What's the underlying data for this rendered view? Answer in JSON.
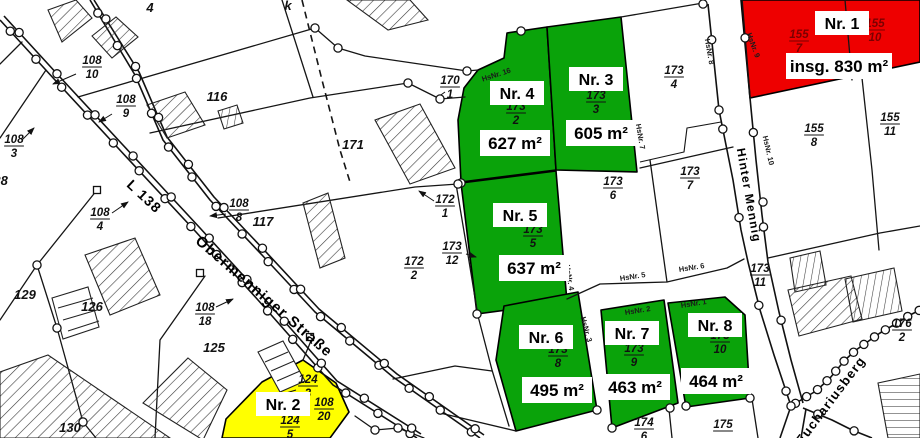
{
  "map": {
    "colors": {
      "lot_available": "#0AA30A",
      "lot_reserved": "#EE0000",
      "lot_sold": "#FFFF00",
      "parcel_label_red": "#7A0000",
      "background": "#FFFFFF"
    },
    "streets": [
      {
        "name": "L 138"
      },
      {
        "name": "Obermenniger Straße"
      },
      {
        "name": "Hinter Mennig"
      },
      {
        "name": "Euchariusberg"
      }
    ],
    "lots": [
      {
        "id": 1,
        "name": "Nr. 1",
        "area": "insg. 830 m²",
        "parcels": [
          "155/7",
          "155/10"
        ],
        "status_color": "lot_reserved"
      },
      {
        "id": 2,
        "name": "Nr. 2",
        "area": "",
        "parcels": [
          "124/3",
          "124/5",
          "108/20"
        ],
        "status_color": "lot_sold"
      },
      {
        "id": 3,
        "name": "Nr. 3",
        "area": "605 m²",
        "parcels": [
          "173/3"
        ],
        "status_color": "lot_available"
      },
      {
        "id": 4,
        "name": "Nr. 4",
        "area": "627 m²",
        "parcels": [
          "173/2"
        ],
        "status_color": "lot_available"
      },
      {
        "id": 5,
        "name": "Nr. 5",
        "area": "637 m²",
        "parcels": [
          "173/5"
        ],
        "status_color": "lot_available"
      },
      {
        "id": 6,
        "name": "Nr. 6",
        "area": "495 m²",
        "parcels": [
          "173/8"
        ],
        "status_color": "lot_available"
      },
      {
        "id": 7,
        "name": "Nr. 7",
        "area": "463 m²",
        "parcels": [
          "173/9"
        ],
        "status_color": "lot_available"
      },
      {
        "id": 8,
        "name": "Nr. 8",
        "area": "464 m²",
        "parcels": [
          "173/10"
        ],
        "status_color": "lot_available"
      }
    ],
    "parcel_labels": [
      {
        "num": "108",
        "den": "10",
        "x": 92,
        "y": 64
      },
      {
        "num": "108",
        "den": "9",
        "x": 126,
        "y": 103
      },
      {
        "num": "108",
        "den": "3",
        "x": 14,
        "y": 143
      },
      {
        "num": "108",
        "den": "4",
        "x": 100,
        "y": 216
      },
      {
        "num": "108",
        "den": "8",
        "x": 239,
        "y": 207
      },
      {
        "num": "108",
        "den": "18",
        "x": 205,
        "y": 311
      },
      {
        "num": "108",
        "den": "20",
        "x": 324,
        "y": 406
      },
      {
        "num": "124",
        "den": "3",
        "x": 308,
        "y": 383
      },
      {
        "num": "124",
        "den": "5",
        "x": 290,
        "y": 424
      },
      {
        "num": "170",
        "den": "1",
        "x": 450,
        "y": 84
      },
      {
        "num": "172",
        "den": "1",
        "x": 445,
        "y": 203
      },
      {
        "num": "172",
        "den": "2",
        "x": 414,
        "y": 265
      },
      {
        "num": "173",
        "den": "12",
        "x": 452,
        "y": 250
      },
      {
        "num": "173",
        "den": "2",
        "x": 516,
        "y": 110
      },
      {
        "num": "173",
        "den": "3",
        "x": 596,
        "y": 99
      },
      {
        "num": "173",
        "den": "4",
        "x": 674,
        "y": 74
      },
      {
        "num": "173",
        "den": "5",
        "x": 533,
        "y": 233
      },
      {
        "num": "173",
        "den": "6",
        "x": 613,
        "y": 185
      },
      {
        "num": "173",
        "den": "7",
        "x": 690,
        "y": 175
      },
      {
        "num": "173",
        "den": "8",
        "x": 558,
        "y": 353
      },
      {
        "num": "173",
        "den": "9",
        "x": 634,
        "y": 352
      },
      {
        "num": "173",
        "den": "10",
        "x": 720,
        "y": 339
      },
      {
        "num": "173",
        "den": "11",
        "x": 760,
        "y": 272
      },
      {
        "num": "155",
        "den": "7",
        "x": 799,
        "y": 38,
        "color": "red"
      },
      {
        "num": "155",
        "den": "10",
        "x": 875,
        "y": 27,
        "color": "red"
      },
      {
        "num": "155",
        "den": "8",
        "x": 814,
        "y": 132
      },
      {
        "num": "155",
        "den": "11",
        "x": 890,
        "y": 121
      },
      {
        "num": "176",
        "den": "2",
        "x": 902,
        "y": 327
      },
      {
        "num": "174",
        "den": "6",
        "x": 644,
        "y": 426
      },
      {
        "num": "175",
        "den": "",
        "x": 723,
        "y": 428
      }
    ],
    "plain_labels": [
      {
        "text": "4",
        "x": 150,
        "y": 12
      },
      {
        "text": "116",
        "x": 217,
        "y": 101
      },
      {
        "text": "117",
        "x": 263,
        "y": 226
      },
      {
        "text": "128",
        "x": -3,
        "y": 185
      },
      {
        "text": "129",
        "x": 25,
        "y": 299
      },
      {
        "text": "126",
        "x": 92,
        "y": 311
      },
      {
        "text": "125",
        "x": 214,
        "y": 352
      },
      {
        "text": "130",
        "x": 70,
        "y": 432
      },
      {
        "text": "171",
        "x": 353,
        "y": 149
      },
      {
        "text": "k",
        "x": 288,
        "y": 10,
        "size": 9
      }
    ],
    "house_number_labels": [
      {
        "text": "HsNr. 16",
        "x": 497,
        "y": 77,
        "rot": -18
      },
      {
        "text": "HsNr. 7",
        "x": 638,
        "y": 137,
        "rot": 80
      },
      {
        "text": "HsNr. 8",
        "x": 707,
        "y": 52,
        "rot": 80
      },
      {
        "text": "HsNr. 9",
        "x": 751,
        "y": 46,
        "rot": 70
      },
      {
        "text": "HsNr. 10",
        "x": 766,
        "y": 151,
        "rot": 77
      },
      {
        "text": "HsNr. 5",
        "x": 633,
        "y": 279,
        "rot": -9
      },
      {
        "text": "HsNr. 6",
        "x": 692,
        "y": 270,
        "rot": -9
      },
      {
        "text": "HsNr. 4",
        "x": 567,
        "y": 278,
        "rot": 80
      },
      {
        "text": "HsNr. 3",
        "x": 584,
        "y": 330,
        "rot": 75
      },
      {
        "text": "HsNr. 2",
        "x": 638,
        "y": 313,
        "rot": -9
      },
      {
        "text": "HsNr. 1",
        "x": 694,
        "y": 306,
        "rot": -9
      }
    ]
  }
}
